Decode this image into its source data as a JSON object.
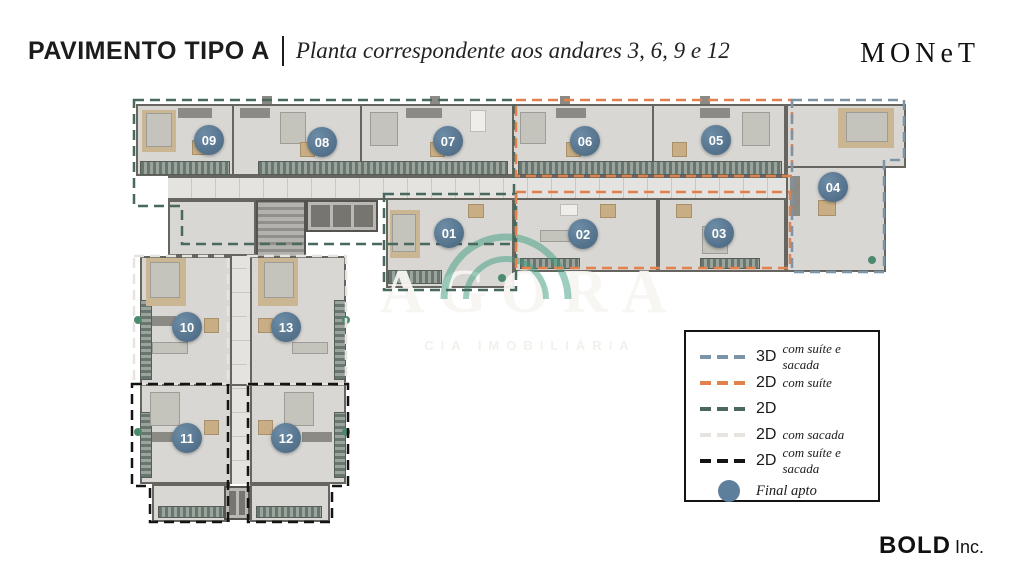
{
  "header": {
    "title_main": "PAVIMENTO TIPO A",
    "title_sub": "Planta correspondente aos andares 3, 6, 9 e 12",
    "logo": "MONeT"
  },
  "footer": {
    "brand_bold": "BOLD",
    "brand_suffix": "Inc."
  },
  "watermark": {
    "name": "AGORA",
    "subtitle": "CIA IMOBILIÁRIA",
    "arc_color": "#3d9e80"
  },
  "legend": {
    "items": [
      {
        "code": "3D",
        "desc": "com suíte e sacada",
        "color": "#7d93a6"
      },
      {
        "code": "2D",
        "desc": "com suíte",
        "color": "#e2814d"
      },
      {
        "code": "2D",
        "desc": "",
        "color": "#49685e"
      },
      {
        "code": "2D",
        "desc": "com sacada",
        "color": "#e7e4df"
      },
      {
        "code": "2D",
        "desc": "com suíte e sacada",
        "color": "#141414"
      }
    ],
    "final": {
      "label": "Final apto",
      "color": "#5d7f9c"
    }
  },
  "units": [
    {
      "label": "01",
      "x": 449,
      "y": 233
    },
    {
      "label": "02",
      "x": 583,
      "y": 234
    },
    {
      "label": "03",
      "x": 719,
      "y": 233
    },
    {
      "label": "04",
      "x": 833,
      "y": 187
    },
    {
      "label": "05",
      "x": 716,
      "y": 140
    },
    {
      "label": "06",
      "x": 585,
      "y": 141
    },
    {
      "label": "07",
      "x": 448,
      "y": 141
    },
    {
      "label": "08",
      "x": 322,
      "y": 142
    },
    {
      "label": "09",
      "x": 209,
      "y": 140
    },
    {
      "label": "10",
      "x": 187,
      "y": 327
    },
    {
      "label": "11",
      "x": 187,
      "y": 438
    },
    {
      "label": "12",
      "x": 286,
      "y": 438
    },
    {
      "label": "13",
      "x": 286,
      "y": 327
    }
  ]
}
